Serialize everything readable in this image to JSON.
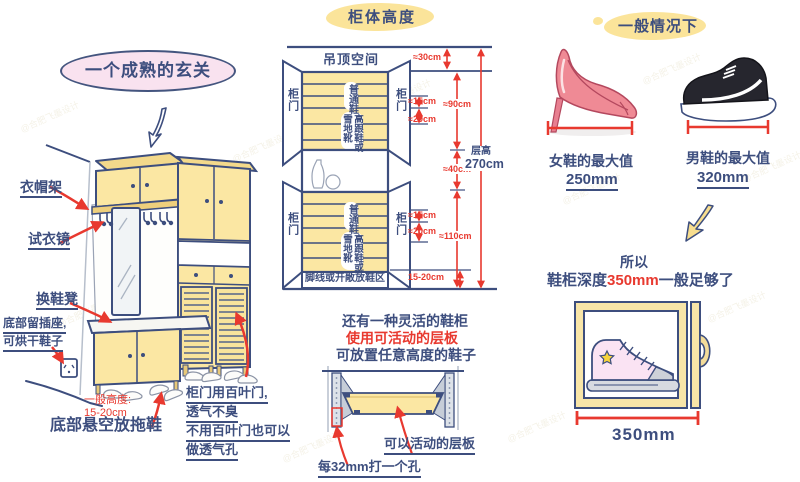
{
  "watermark": "@合肥飞墨设计",
  "colors": {
    "navy": "#3d4e7e",
    "red": "#e8392f",
    "cabinet_yellow": "#fbe7a3",
    "title_pink": "#f9e2ef",
    "highlight_yellow": "#fbe49a"
  },
  "left": {
    "title": "一个成熟的玄关",
    "coat_rack": "衣帽架",
    "mirror": "试衣镜",
    "bench": "换鞋凳",
    "socket1": "底部留插座,",
    "socket2": "可烘干鞋子",
    "height1": "一般高度:",
    "height2": "15-20cm",
    "slippers": "底部悬空放拖鞋",
    "louver1": "柜门用百叶门,",
    "louver2": "透气不臭",
    "louver3": "不用百叶门也可以",
    "louver4": "做透气孔"
  },
  "middle": {
    "title": "柜体高度",
    "ceiling": "吊顶空间",
    "door": "柜门",
    "regular": "普通鞋",
    "boots": "高跟鞋或雪地靴",
    "base_zone": "脚线或开敞放鞋区",
    "dims": {
      "d30": "≈30cm",
      "d15": "≈15cm",
      "d20": "≈20cm",
      "d90": "≈90cm",
      "d40": "≈40cm",
      "d110": "≈110cm",
      "dbase": "15-20cm",
      "floor_label": "层高",
      "floor_value": "270cm"
    },
    "flex1": "还有一种灵活的鞋柜",
    "flex2": "使用可活动的层板",
    "flex3": "可放置任意高度的鞋子",
    "movable": "可以活动的层板",
    "hole": "每32mm打一个孔"
  },
  "right": {
    "title": "一般情况下",
    "women_label": "女鞋的最大值",
    "women_value": "250mm",
    "men_label": "男鞋的最大值",
    "men_value": "320mm",
    "so": "所以",
    "concl_pre": "鞋柜深度",
    "concl_value": "350mm",
    "concl_post": "一般足够了",
    "depth": "350mm"
  }
}
